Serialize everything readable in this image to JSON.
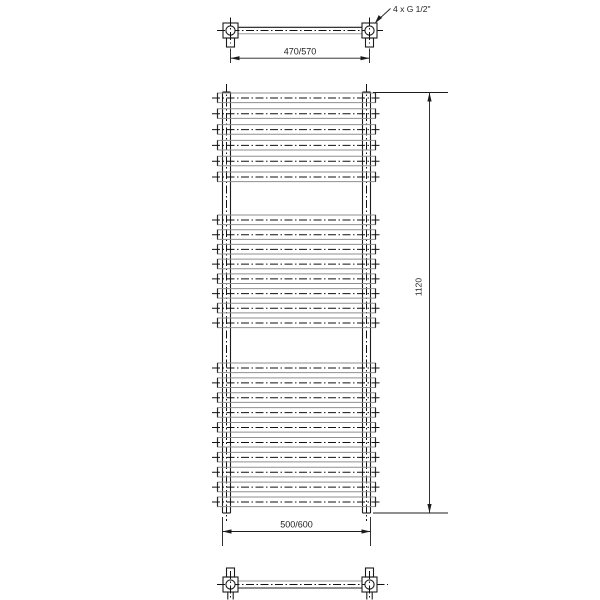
{
  "drawing": {
    "title": "towel-radiator-technical-drawing",
    "subject": "ladder towel radiator shown in top, front and bottom views with dimensions",
    "labels": {
      "connection_note": "4 x G 1/2\"",
      "top_width": "470/570",
      "height": "1120",
      "bottom_width": "500/600"
    },
    "front_view": {
      "rung_groups": [
        6,
        8,
        10
      ],
      "total_rungs": 24
    },
    "colors": {
      "line": "#1c1c1c",
      "secondary_line": "#9a9a9a",
      "background": "#ffffff"
    }
  }
}
